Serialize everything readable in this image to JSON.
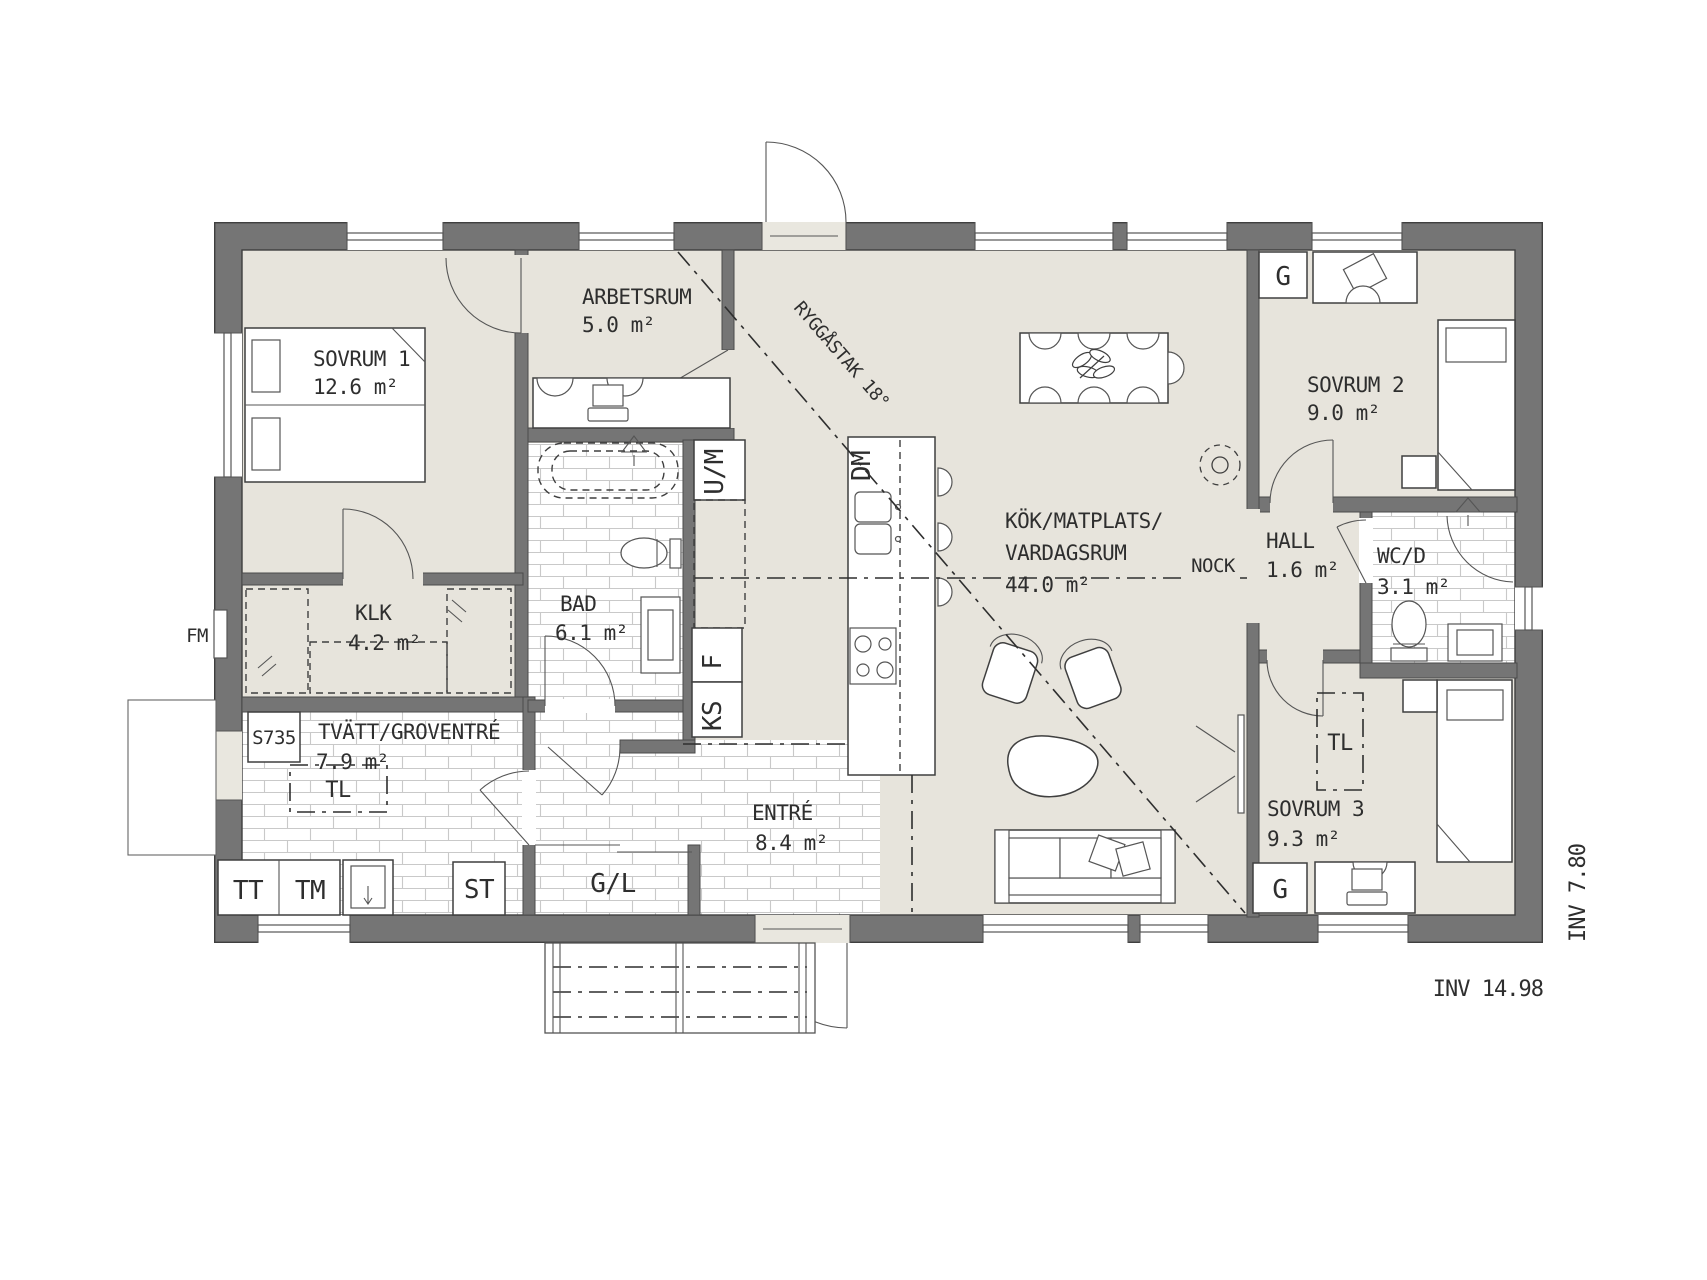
{
  "title": "House floor plan S735",
  "colors": {
    "wall": "#757575",
    "floor": "#e7e4dc",
    "tile-line": "#c9c9c9",
    "ink": "#2e2e2e",
    "light": "#e9e7df"
  },
  "rooms": {
    "sovrum1": {
      "name": "SOVRUM 1",
      "area": "12.6 m²"
    },
    "arbetsrum": {
      "name": "ARBETSRUM",
      "area": "5.0 m²"
    },
    "klk": {
      "name": "KLK",
      "area": "4.2 m²"
    },
    "bad": {
      "name": "BAD",
      "area": "6.1 m²"
    },
    "tvatt": {
      "name": "TVÄTT/GROVENTRÉ",
      "area": "7.9 m²"
    },
    "entre": {
      "name": "ENTRÉ",
      "area": "8.4 m²"
    },
    "kok": {
      "name_line1": "KÖK/MATPLATS/",
      "name_line2": "VARDAGSRUM",
      "area": "44.0 m²"
    },
    "hall": {
      "name": "HALL",
      "area": "1.6 m²"
    },
    "sovrum2": {
      "name": "SOVRUM 2",
      "area": "9.0 m²"
    },
    "wcd": {
      "name": "WC/D",
      "area": "3.1 m²"
    },
    "sovrum3": {
      "name": "SOVRUM 3",
      "area": "9.3 m²"
    }
  },
  "fixtures": {
    "um": "U/M",
    "f": "F",
    "ks": "KS",
    "dm": "DM",
    "tl": "TL",
    "s735": "S735",
    "fm": "FM",
    "tt": "TT",
    "tm": "TM",
    "st": "ST",
    "gl": "G/L",
    "g": "G"
  },
  "annotations": {
    "ridge": "RYGGÅSTAK 18°",
    "nock": "NOCK",
    "inv_width": "INV 14.98",
    "inv_height": "INV 7.80"
  }
}
